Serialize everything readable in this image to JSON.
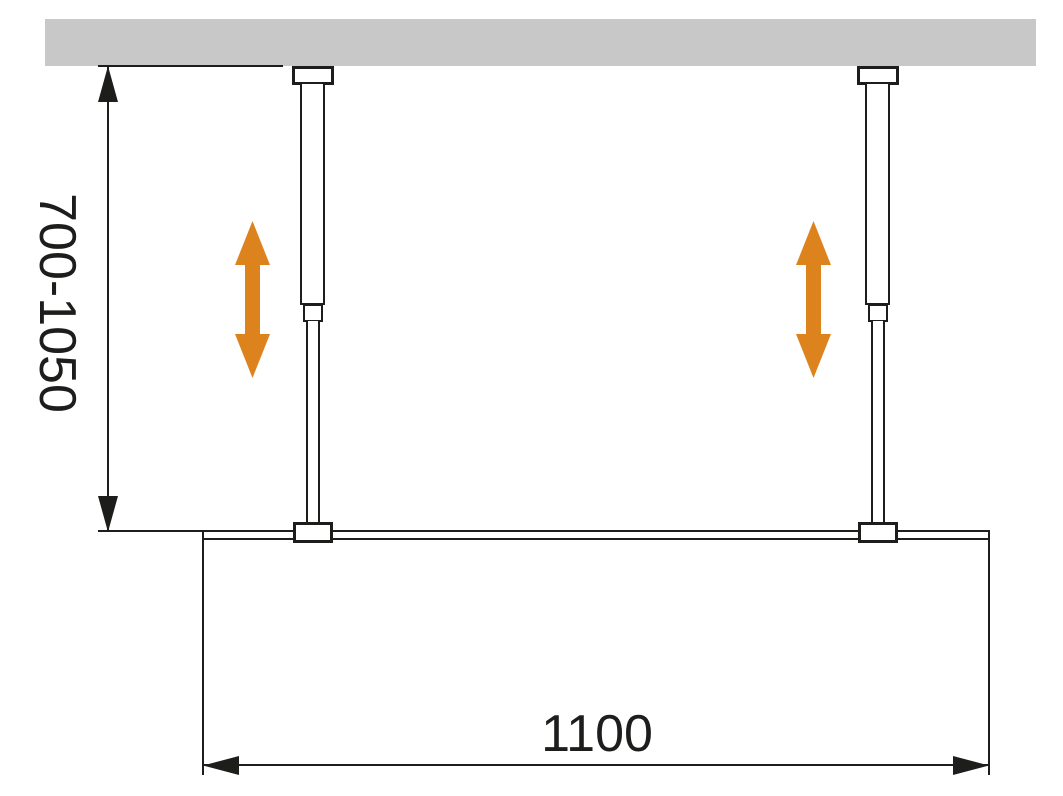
{
  "labels": {
    "height_range": "700-1050",
    "width": "1100"
  },
  "colors": {
    "ceiling_gray": "#C8C8C8",
    "line_ink": "#1D1D1B",
    "arrow_orange": "#DD831E",
    "background": "#FFFFFF"
  },
  "icons": {
    "adjust_arrows": "vertical-double-arrow"
  }
}
